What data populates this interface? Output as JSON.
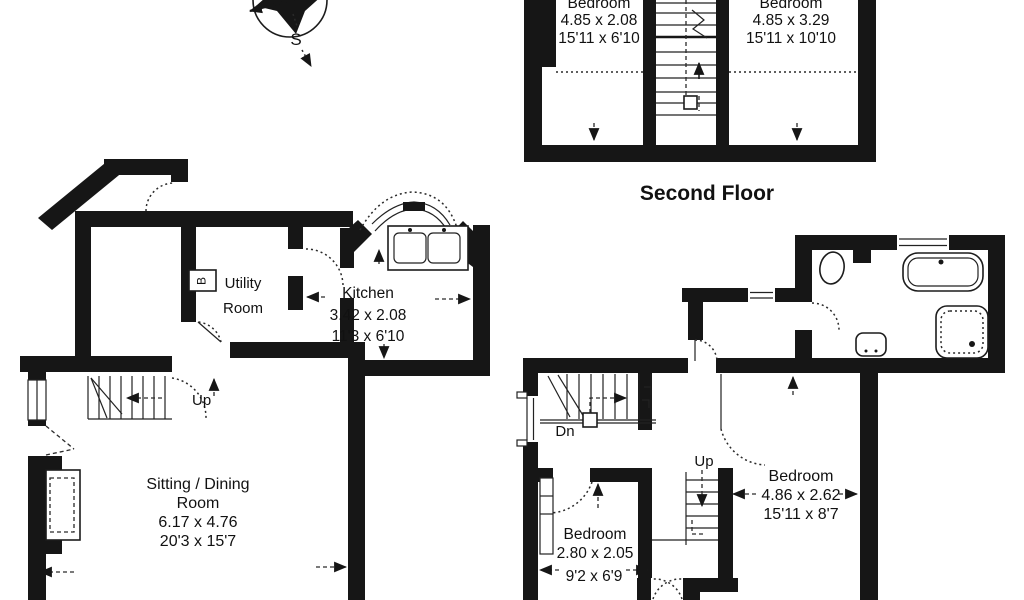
{
  "document": {
    "kind": "estate-agent floor plan scan"
  },
  "colors": {
    "ink": "#161616",
    "paper": "#ffffff"
  },
  "compass": {
    "south_label": "S"
  },
  "second_floor": {
    "title": "Second Floor",
    "bedroom_left": {
      "name": "Bedroom",
      "metric": "4.85 x 2.08",
      "imperial": "15'11 x 6'10"
    },
    "bedroom_right": {
      "name": "Bedroom",
      "metric": "4.85 x 3.29",
      "imperial": "15'11 x 10'10"
    }
  },
  "ground_floor": {
    "utility_room": {
      "line1": "Utility",
      "line2": "Room"
    },
    "boiler_label": "B",
    "kitchen": {
      "name": "Kitchen",
      "metric": "3.42 x 2.08",
      "imperial": "11'3 x 6'10"
    },
    "stairs_label": "Up",
    "sitting_dining": {
      "line1": "Sitting / Dining",
      "line2": "Room",
      "metric": "6.17 x 4.76",
      "imperial": "20'3 x 15'7"
    }
  },
  "first_floor": {
    "stairs_down_label": "Dn",
    "stairs_up_label": "Up",
    "bedroom_small": {
      "name": "Bedroom",
      "metric": "2.80 x 2.05",
      "imperial": "9'2 x 6'9"
    },
    "bedroom_large": {
      "name": "Bedroom",
      "metric": "4.86 x 2.62",
      "imperial": "15'11 x 8'7"
    }
  }
}
